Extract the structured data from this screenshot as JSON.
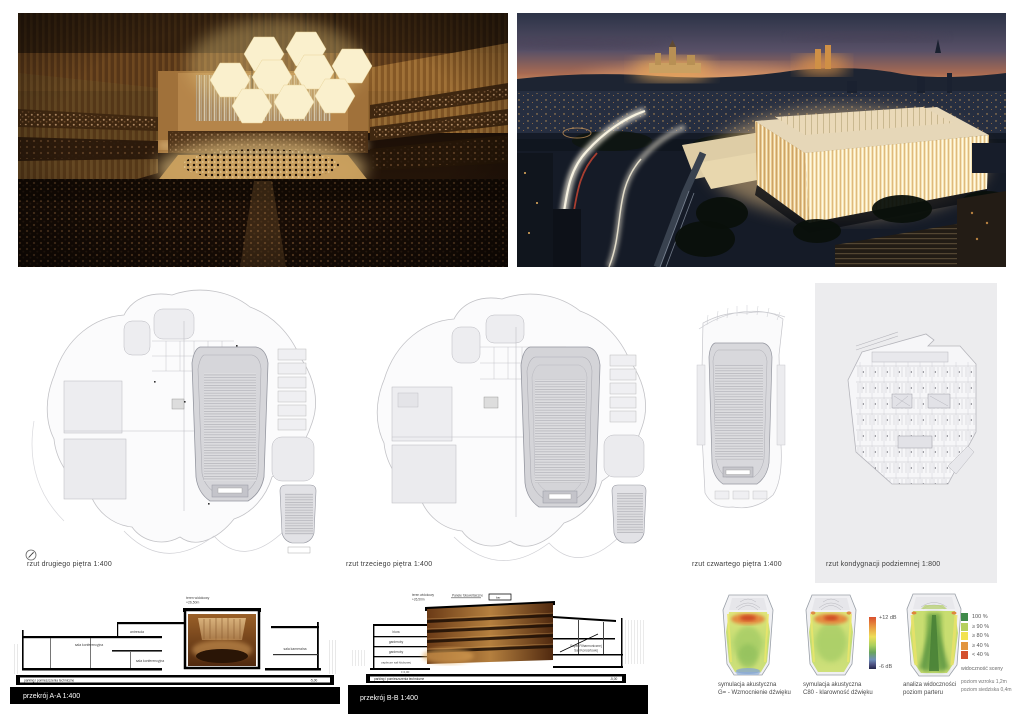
{
  "plans": {
    "p1": {
      "label": "rzut drugiego piętra 1:400"
    },
    "p2": {
      "label": "rzut trzeciego piętra 1:400"
    },
    "p3": {
      "label": "rzut czwartego piętra 1:400"
    },
    "p4": {
      "label": "rzut kondygnacji podziemnej 1:800"
    }
  },
  "sections": {
    "a": {
      "label": "przekrój A-A 1:400",
      "top_note": "teren widokowy",
      "top_level": "+26,50m",
      "mezz": "antresola",
      "room1": "sala konferencyjna",
      "room2": "sala konferencyjna",
      "room3": "sala kameralna",
      "parking": "parking i pomieszczenia techniczne",
      "level_low": "-5,00"
    },
    "b": {
      "label": "przekrój B-B 1:400",
      "top_note": "teren widokowy",
      "top_level": "+26,50m",
      "pv": "Panele fotowoltaiczne",
      "bar": "bar",
      "room1": "biura",
      "room2": "garderoby",
      "room3": "garderoby",
      "room4": "zaplecze sali klubowej",
      "foyer1": "Foyer Filharmonicznej",
      "foyer2": "Sali Koncertowej",
      "level0": "± 0,00",
      "parking": "parking i pomieszczenia techniczne",
      "level_low": "-5,00"
    }
  },
  "analyses": {
    "a1": {
      "line1": "symulacja akustyczna",
      "line2": "G= - Wzmocnienie dźwięku"
    },
    "a2": {
      "line1": "symulacja akustyczna",
      "line2": "C80 - klarowność dźwięku"
    },
    "a3": {
      "line1": "analiza widoczności",
      "line2": "poziom parteru"
    }
  },
  "db_scale": {
    "top": "+12 dB",
    "bottom": "-6 dB"
  },
  "visibility_legend": {
    "rows": [
      {
        "label": "100 %",
        "color": "#3f8a4a"
      },
      {
        "label": "≥ 90 %",
        "color": "#b5d05e"
      },
      {
        "label": "≥ 80 %",
        "color": "#f2e24e"
      },
      {
        "label": "≥ 40 %",
        "color": "#e2953f"
      },
      {
        "label": "< 40 %",
        "color": "#d4502e"
      }
    ],
    "caption": "widoczność sceny",
    "note1": "poziom wzroku 1,2m",
    "note2": "poziom siedziska 0,4m"
  },
  "colors": {
    "acoustic_orange": "#e6813a",
    "acoustic_green": "#a6cc66",
    "db_top": "#d94f2e",
    "db_bottom": "#23264a",
    "wood": "#a5763a",
    "sky_orange": "#d99a63"
  }
}
